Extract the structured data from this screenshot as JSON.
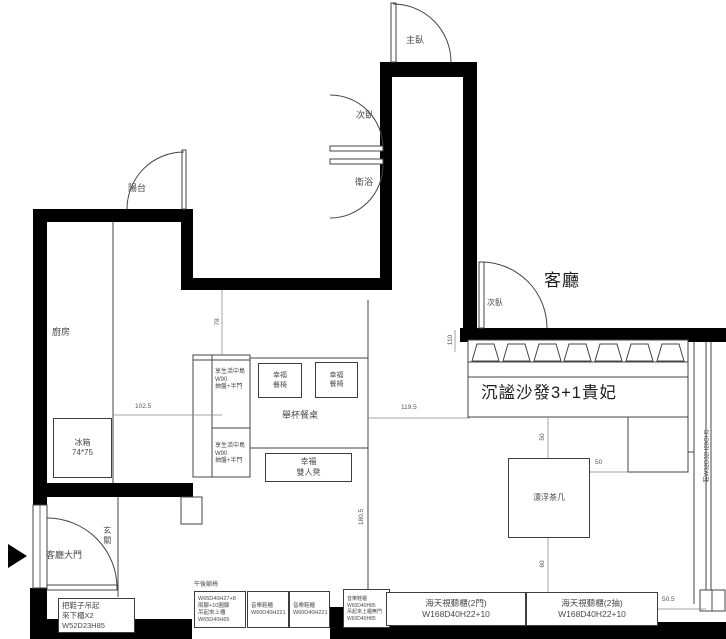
{
  "colors": {
    "wall": "#000000",
    "line": "#444444",
    "text": "#4a4a4a"
  },
  "labels": [
    {
      "name": "room-label-balcony",
      "text": "陽台",
      "x": 128,
      "y": 184,
      "size": 9
    },
    {
      "name": "room-label-kitchen",
      "text": "廚房",
      "x": 52,
      "y": 328,
      "size": 9
    },
    {
      "name": "room-label-master-bedroom",
      "text": "主臥",
      "x": 406,
      "y": 36,
      "size": 9
    },
    {
      "name": "room-label-bedroom-2",
      "text": "次臥",
      "x": 356,
      "y": 111,
      "size": 9
    },
    {
      "name": "room-label-bathroom",
      "text": "衛浴",
      "x": 355,
      "y": 178,
      "size": 9
    },
    {
      "name": "room-label-bedroom-3",
      "text": "次臥",
      "x": 487,
      "y": 299,
      "size": 8
    },
    {
      "name": "room-label-living-room",
      "text": "客廳",
      "x": 544,
      "y": 272,
      "size": 17,
      "cls": "big"
    },
    {
      "name": "room-label-foyer",
      "text": "玄關",
      "x": 102,
      "y": 526,
      "size": 8,
      "cls": "vert"
    },
    {
      "name": "door-label-main-entrance",
      "text": "客廳大門",
      "x": 46,
      "y": 551,
      "size": 9
    },
    {
      "name": "table-label-dining",
      "text": "舉杯餐桌",
      "x": 282,
      "y": 411,
      "size": 9
    },
    {
      "name": "sofa-label",
      "text": "沉謐沙發3+1貴妃",
      "x": 481,
      "y": 384,
      "size": 16.5,
      "cls": "big"
    },
    {
      "name": "note-bench-header",
      "text": "午後躺椅",
      "x": 194,
      "y": 582,
      "size": 6
    },
    {
      "name": "note-right-shoe-cabinet",
      "text": "鞋W32D32H20GH5",
      "x": 708,
      "y": 456,
      "size": 6,
      "cls": "rot"
    }
  ],
  "dims": [
    {
      "name": "dim-kitchen-width",
      "text": "102.5",
      "x": 135,
      "y": 404
    },
    {
      "name": "dim-dining-width",
      "text": "119.5",
      "x": 401,
      "y": 405
    },
    {
      "name": "dim-island-gap",
      "text": "78",
      "x": 218,
      "y": 322,
      "rot": true
    },
    {
      "name": "dim-corridor",
      "text": "110",
      "x": 451,
      "y": 340,
      "rot": true
    },
    {
      "name": "dim-dining-length",
      "text": "180.5",
      "x": 362,
      "y": 517,
      "rot": true
    },
    {
      "name": "dim-sofa-table-gap",
      "text": "50",
      "x": 543,
      "y": 437,
      "rot": true
    },
    {
      "name": "dim-table-chaise-gap",
      "text": "50",
      "x": 595,
      "y": 460
    },
    {
      "name": "dim-table-bottom-gap",
      "text": "60",
      "x": 543,
      "y": 564,
      "rot": true
    },
    {
      "name": "dim-tv-wall-gap",
      "text": "50.5",
      "x": 662,
      "y": 597
    }
  ],
  "boxes": [
    {
      "name": "fridge",
      "x": 53,
      "y": 418,
      "w": 59,
      "h": 60,
      "size": 8,
      "lines": [
        "冰箱",
        "74*75"
      ]
    },
    {
      "name": "dining-chair-1",
      "x": 258,
      "y": 363,
      "w": 44,
      "h": 35,
      "size": 7,
      "lines": [
        "幸福",
        "餐椅"
      ]
    },
    {
      "name": "dining-chair-2",
      "x": 315,
      "y": 362,
      "w": 43,
      "h": 36,
      "size": 7,
      "lines": [
        "幸福",
        "餐椅"
      ]
    },
    {
      "name": "double-bench",
      "x": 265,
      "y": 453,
      "w": 87,
      "h": 29,
      "size": 8,
      "lines": [
        "幸福",
        "雙人凳"
      ]
    },
    {
      "name": "tea-table",
      "x": 508,
      "y": 458,
      "w": 82,
      "h": 80,
      "size": 8,
      "lines": [
        "漂浮茶几"
      ]
    },
    {
      "name": "island-upper-note",
      "x": 212,
      "y": 364,
      "w": 38,
      "h": 32,
      "size": 6,
      "cls": "left nob",
      "lines": [
        "享生活中島",
        "W90",
        "抽盤+半門"
      ]
    },
    {
      "name": "island-lower-note",
      "x": 212,
      "y": 438,
      "w": 38,
      "h": 32,
      "size": 6,
      "cls": "left nob",
      "lines": [
        "享生活中島",
        "W90",
        "抽盤+半門"
      ]
    },
    {
      "name": "shoe-hang-cabinet-note",
      "x": 58,
      "y": 598,
      "w": 77,
      "h": 35,
      "size": 7.5,
      "cls": "left",
      "lines": [
        "把鞋子吊起",
        "來下櫃X2",
        "W52D23H85"
      ]
    },
    {
      "name": "bench-cabinet-note",
      "x": 194,
      "y": 591,
      "w": 52,
      "h": 37,
      "size": 5.5,
      "cls": "left",
      "lines": [
        "W65D40H27+8",
        "兩腳+10圓腳",
        "吊起來上櫃",
        "W65D40H65"
      ]
    },
    {
      "name": "music-shoe-cabinet-1",
      "x": 247,
      "y": 591,
      "w": 42,
      "h": 37,
      "size": 5.5,
      "cls": "left",
      "lines": [
        "音樂鞋櫃",
        "W60D40H221"
      ]
    },
    {
      "name": "music-shoe-cabinet-2",
      "x": 289,
      "y": 591,
      "w": 41,
      "h": 37,
      "size": 5.5,
      "cls": "left",
      "lines": [
        "音樂鞋櫃",
        "W60D40H221"
      ]
    },
    {
      "name": "music-shoe-cabinet-3",
      "x": 343,
      "y": 589,
      "w": 47,
      "h": 39,
      "size": 5,
      "cls": "left",
      "lines": [
        "音樂鞋櫃",
        "W60D40H85",
        "吊起來上櫃無門",
        "W60D40H85"
      ]
    },
    {
      "name": "tv-cabinet-2door",
      "x": 386,
      "y": 592,
      "w": 140,
      "h": 34,
      "size": 8.5,
      "lines": [
        "海天視聽櫃(2門)",
        "W168D40H22+10"
      ]
    },
    {
      "name": "tv-cabinet-2drawer",
      "x": 526,
      "y": 592,
      "w": 132,
      "h": 34,
      "size": 8.5,
      "lines": [
        "海天視聽櫃(2抽)",
        "W168D40H22+10"
      ]
    }
  ]
}
